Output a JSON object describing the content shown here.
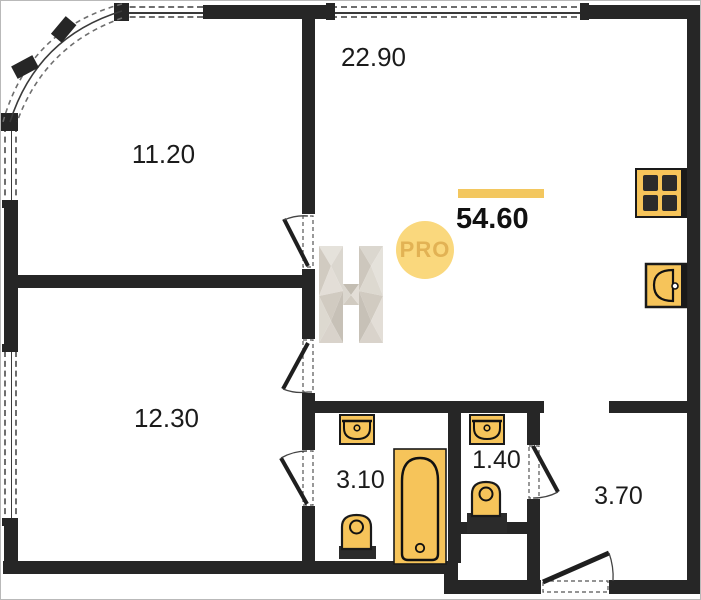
{
  "plan": {
    "total": {
      "area": "54.60"
    },
    "rooms": [
      {
        "id": "bedroom-top-left",
        "area": "11.20"
      },
      {
        "id": "living-kitchen",
        "area": "22.90"
      },
      {
        "id": "bedroom-bottom-left",
        "area": "12.30"
      },
      {
        "id": "bathroom",
        "area": "3.10"
      },
      {
        "id": "wc",
        "area": "1.40"
      },
      {
        "id": "hallway",
        "area": "3.70"
      }
    ],
    "watermark": {
      "badge": "PRO",
      "letter": "H"
    },
    "fixtures": [
      "stove-icon",
      "kitchen-sink-icon",
      "bathroom-sink-icon",
      "wc-sink-icon",
      "toilet-icon",
      "wc-toilet-icon",
      "bathtub-icon"
    ],
    "colors": {
      "wall": "#262626",
      "fixture_fill": "#F6C45A",
      "accent_bar": "#F3C75F",
      "pro_badge_bg": "#FAD87D",
      "pro_badge_text": "#E2B254"
    }
  }
}
